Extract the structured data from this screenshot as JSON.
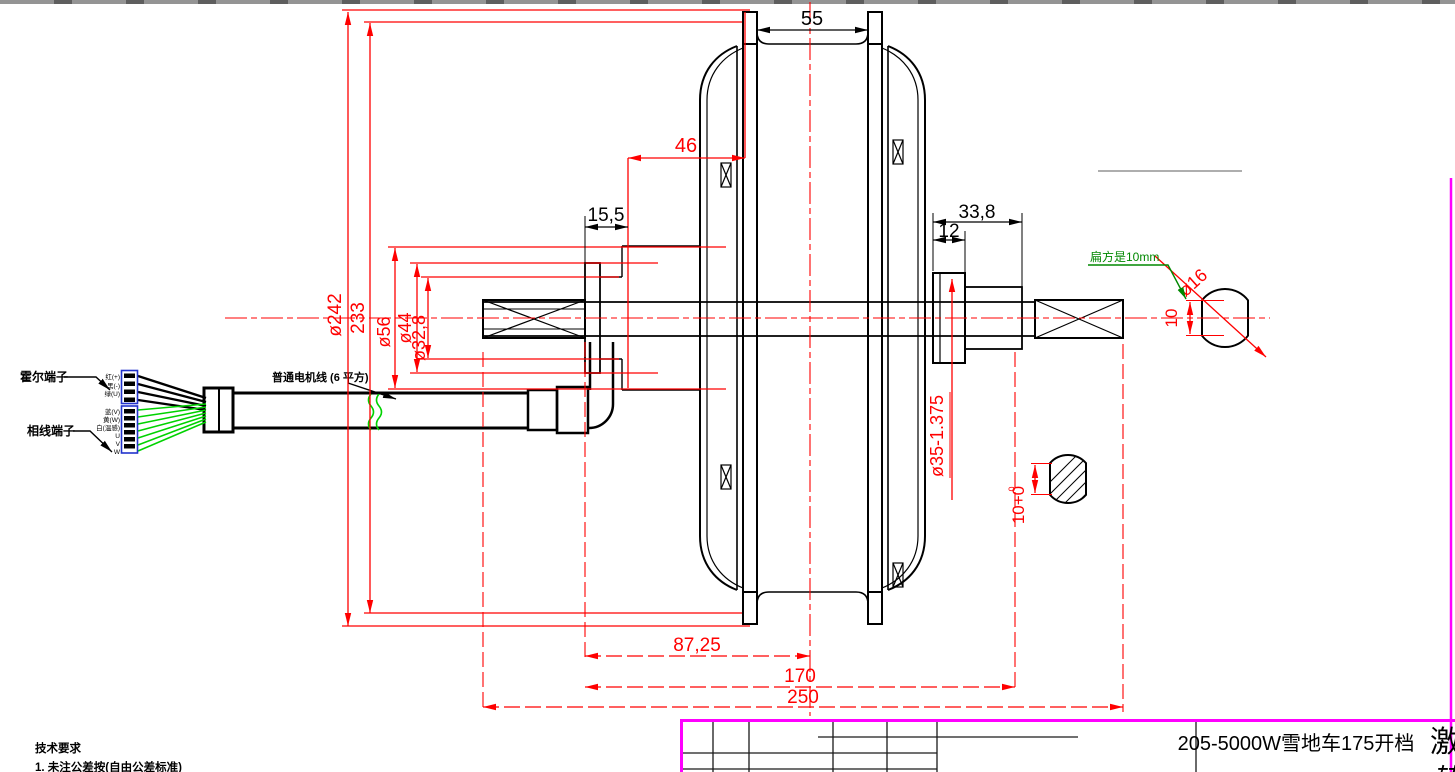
{
  "drawing": {
    "title": "205-5000W雪地车175开档",
    "watermark": "激",
    "watermark2": "转",
    "tech_notes": {
      "heading": "技术要求",
      "line1": "1. 未注公差按(自由公差标准)"
    },
    "labels": {
      "hall_terminal": "霍尔端子",
      "phase_terminal": "相线端子",
      "motor_cable": "普通电机线 (6 平方)",
      "flat_note": "扁方是10mm"
    },
    "wire_labels": [
      "红(+)",
      "黑(-)",
      "绿(U)",
      "蓝(V)",
      "黄(W)",
      "白(温感)",
      "U",
      "V",
      "W"
    ],
    "dimensions": {
      "rim_width": "55",
      "hub_offset": "15,5",
      "stator_offset": "46",
      "right_length": "33,8",
      "right_step": "12",
      "dia_rotor": "ø242",
      "dia_rim": "233",
      "dia_hub": "ø56",
      "dia_flange": "ø44",
      "dia_tube": "ø32,8",
      "freewheel_thread": "ø35-1.375",
      "bearing_to_center": "87,25",
      "shoulder_span": "170",
      "axle_length": "250",
      "shaft_dia": "ø16",
      "shaft_flat": "10",
      "keyway_width": "10+0",
      "keyway_tol_sup": "0"
    },
    "colors": {
      "dimension_red": "#ff0000",
      "wire_green": "#00d200",
      "annotation_green": "#008800",
      "frame_magenta": "#ff00ff",
      "connector_blue": "#2233cc"
    }
  }
}
